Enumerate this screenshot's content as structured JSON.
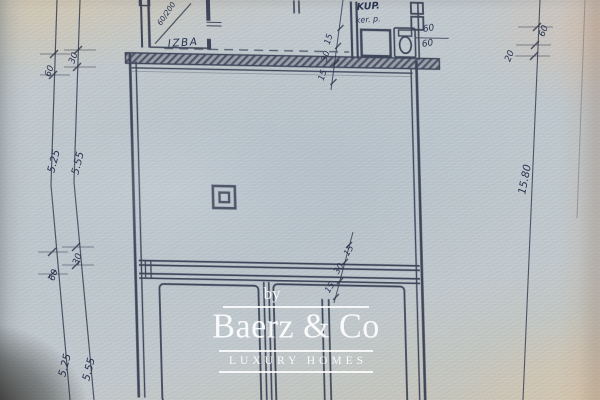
{
  "watermark": {
    "prefix": "by",
    "brand": "Baerz & Co",
    "tagline": "LUXURY HOMES"
  },
  "plan": {
    "room_labels": {
      "izba": "IZBA",
      "kup": "KUP.",
      "kup_sub": "ker. p."
    },
    "door_spec": "60/200"
  },
  "dimensions": {
    "left_upper_offsets": [
      "60",
      "30"
    ],
    "left_upper_spans": [
      "5.25",
      "5.55"
    ],
    "left_lower_offsets": [
      "60",
      "30"
    ],
    "left_lower_spans": [
      "5.25",
      "5.55"
    ],
    "wall_chain_top": [
      "15",
      "30",
      "15"
    ],
    "wall_chain_mid": [
      "15",
      "30",
      "15"
    ],
    "right_offsets": [
      "60",
      "20"
    ],
    "right_span": "15.80",
    "bath_fixture_dims": [
      "60",
      "60"
    ]
  },
  "colors": {
    "ink": "#2c3348",
    "paper": "#bec9d0",
    "watermark": "#ffffff"
  }
}
